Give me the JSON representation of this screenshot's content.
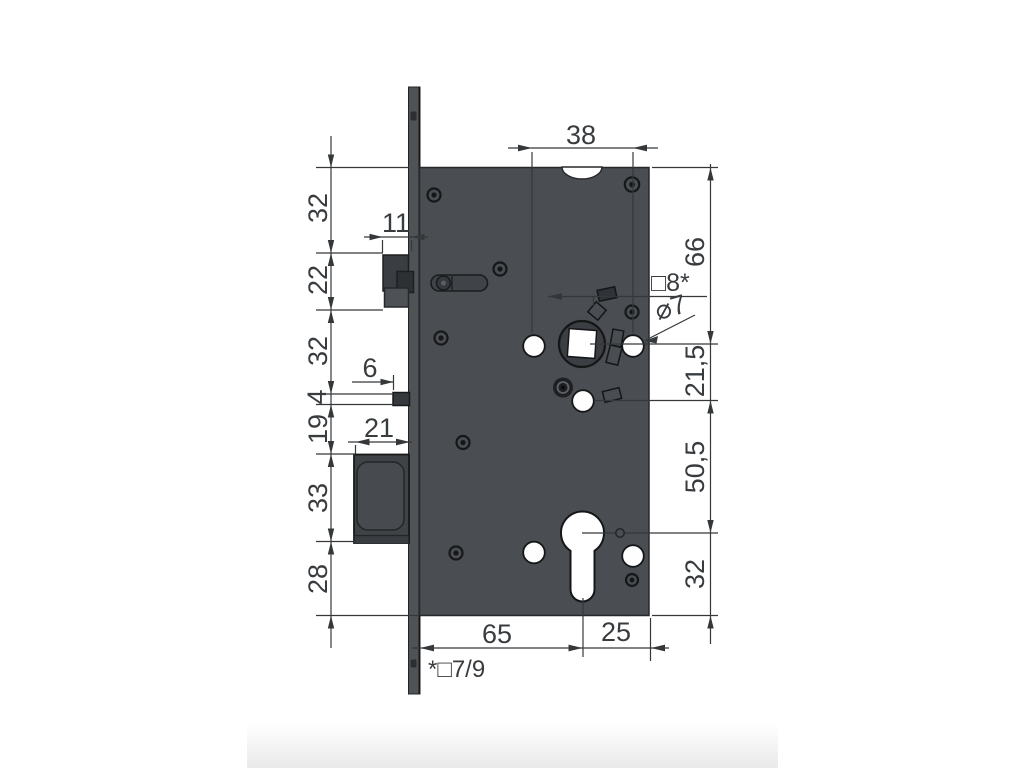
{
  "drawing": {
    "kind": "mortise-lock dimensional drawing",
    "labels": {
      "top_38": "38",
      "left_32a": "32",
      "left_22": "22",
      "left_32b": "32",
      "left_4": "4",
      "left_19": "19",
      "left_33": "33",
      "left_28": "28",
      "small_11": "11",
      "small_6": "6",
      "small_21": "21",
      "right_66": "66",
      "right_21_5": "21,5",
      "right_50_5": "50,5",
      "right_32": "32",
      "bottom_65": "65",
      "bottom_25": "25",
      "callout_square8": "□8*",
      "callout_dia7": "⌀7",
      "footnote": "*□7/9"
    }
  },
  "colors": {
    "background": "#ffffff",
    "body_gray": "#4a4d51",
    "bolt_gray": "#3f4246",
    "faceplate_gray": "#505356",
    "line_color": "#35383b",
    "text_color": "#393c3f",
    "outline_dark": "#17191b"
  }
}
